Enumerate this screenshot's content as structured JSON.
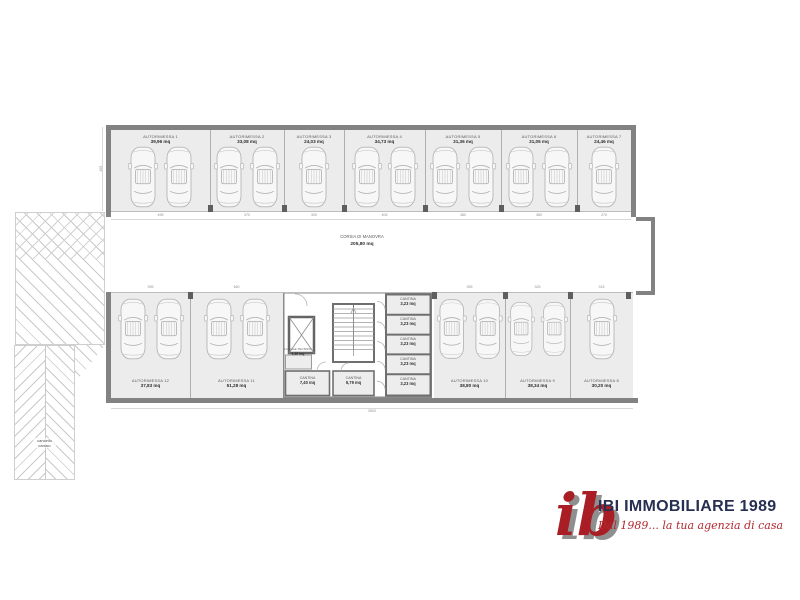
{
  "plan": {
    "corridor": {
      "name": "CORSIA DI MANOVRA",
      "area": "205,80 mq"
    },
    "ramp": {
      "gate_label": "cancello carraio"
    },
    "top_row": [
      {
        "name": "AUTORIMESSA 1",
        "area": "39,96 mq",
        "cars": 2
      },
      {
        "name": "AUTORIMESSA 2",
        "area": "33,08 mq",
        "cars": 2
      },
      {
        "name": "AUTORIMESSA 3",
        "area": "24,03 mq",
        "cars": 1
      },
      {
        "name": "AUTORIMESSA 4",
        "area": "34,73 mq",
        "cars": 2
      },
      {
        "name": "AUTORIMESSA 5",
        "area": "31,36 mq",
        "cars": 2
      },
      {
        "name": "AUTORIMESSA 6",
        "area": "31,05 mq",
        "cars": 2
      },
      {
        "name": "AUTORIMESSA 7",
        "area": "24,46 mq",
        "cars": 1
      }
    ],
    "bottom_left_row": [
      {
        "name": "AUTORIMESSA 12",
        "area": "37,83 mq",
        "cars": 2
      },
      {
        "name": "AUTORIMESSA 11",
        "area": "51,28 mq",
        "cars": 2
      }
    ],
    "bottom_right_row": [
      {
        "name": "AUTORIMESSA 10",
        "area": "38,80 mq",
        "cars": 2
      },
      {
        "name": "AUTORIMESSA 9",
        "area": "38,34 mq",
        "cars": 2
      },
      {
        "name": "AUTORIMESSA 8",
        "area": "30,20 mq",
        "cars": 1
      }
    ],
    "core": {
      "technical_room": {
        "name": "LOCALE TECNICO",
        "area": "1,40 mq"
      },
      "cellars_bottom": [
        {
          "name": "CANTINA",
          "area": "7,40 mq"
        },
        {
          "name": "CANTINA",
          "area": "5,79 mq"
        }
      ],
      "cellars_right": [
        {
          "name": "CANTINA",
          "area": "3,23 mq"
        },
        {
          "name": "CANTINA",
          "area": "3,23 mq"
        },
        {
          "name": "CANTINA",
          "area": "3,23 mq"
        },
        {
          "name": "CANTINA",
          "area": "3,23 mq"
        },
        {
          "name": "CANTINA",
          "area": "3,23 mq"
        }
      ]
    },
    "dimensions": {
      "top": [
        "495",
        "370",
        "300",
        "405",
        "380",
        "380",
        "270"
      ],
      "bottom": [
        "395",
        "460",
        "355",
        "325",
        "315"
      ],
      "side": "405",
      "overall": "2600"
    }
  },
  "logo": {
    "monogram": "ib",
    "brand": "IBI IMMOBILIARE 1989",
    "tagline": "Dal 1989... la tua agenzia di casa",
    "colors": {
      "red": "#a91e24",
      "navy": "#272f52",
      "gray": "#8f8f8f"
    }
  }
}
